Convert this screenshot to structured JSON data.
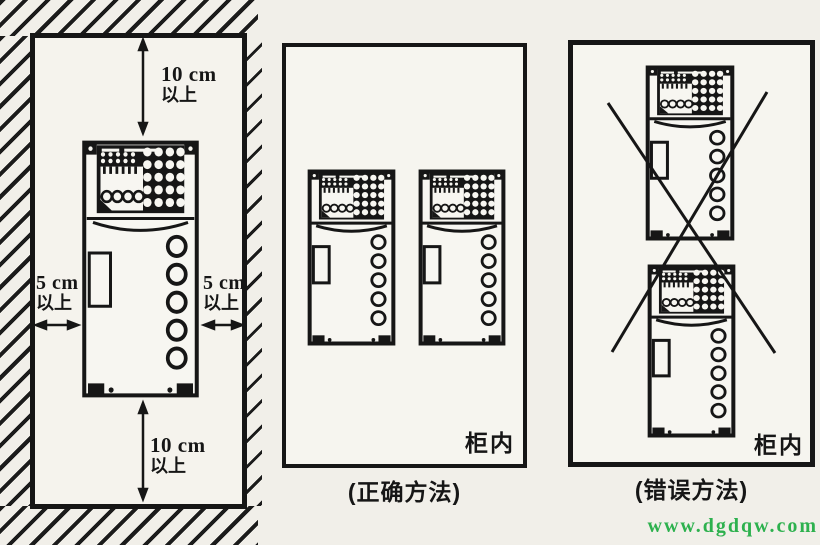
{
  "left_panel": {
    "clearance_top": {
      "value": "10 cm",
      "note": "以上"
    },
    "clearance_bottom": {
      "value": "10 cm",
      "note": "以上"
    },
    "clearance_left": {
      "value": "5 cm",
      "note": "以上"
    },
    "clearance_right": {
      "value": "5 cm",
      "note": "以上"
    }
  },
  "correct_panel": {
    "cabinet_label": "柜内",
    "caption": "(正确方法)"
  },
  "wrong_panel": {
    "cabinet_label": "柜内",
    "caption": "(错误方法)"
  },
  "watermark": {
    "text": "www.dgdqw.com",
    "color": "#2db14e"
  },
  "colors": {
    "line": "#161616",
    "paper": "#f1efe9",
    "panel_fill": "#f6f5ef",
    "watermark_green": "#2db14e"
  }
}
